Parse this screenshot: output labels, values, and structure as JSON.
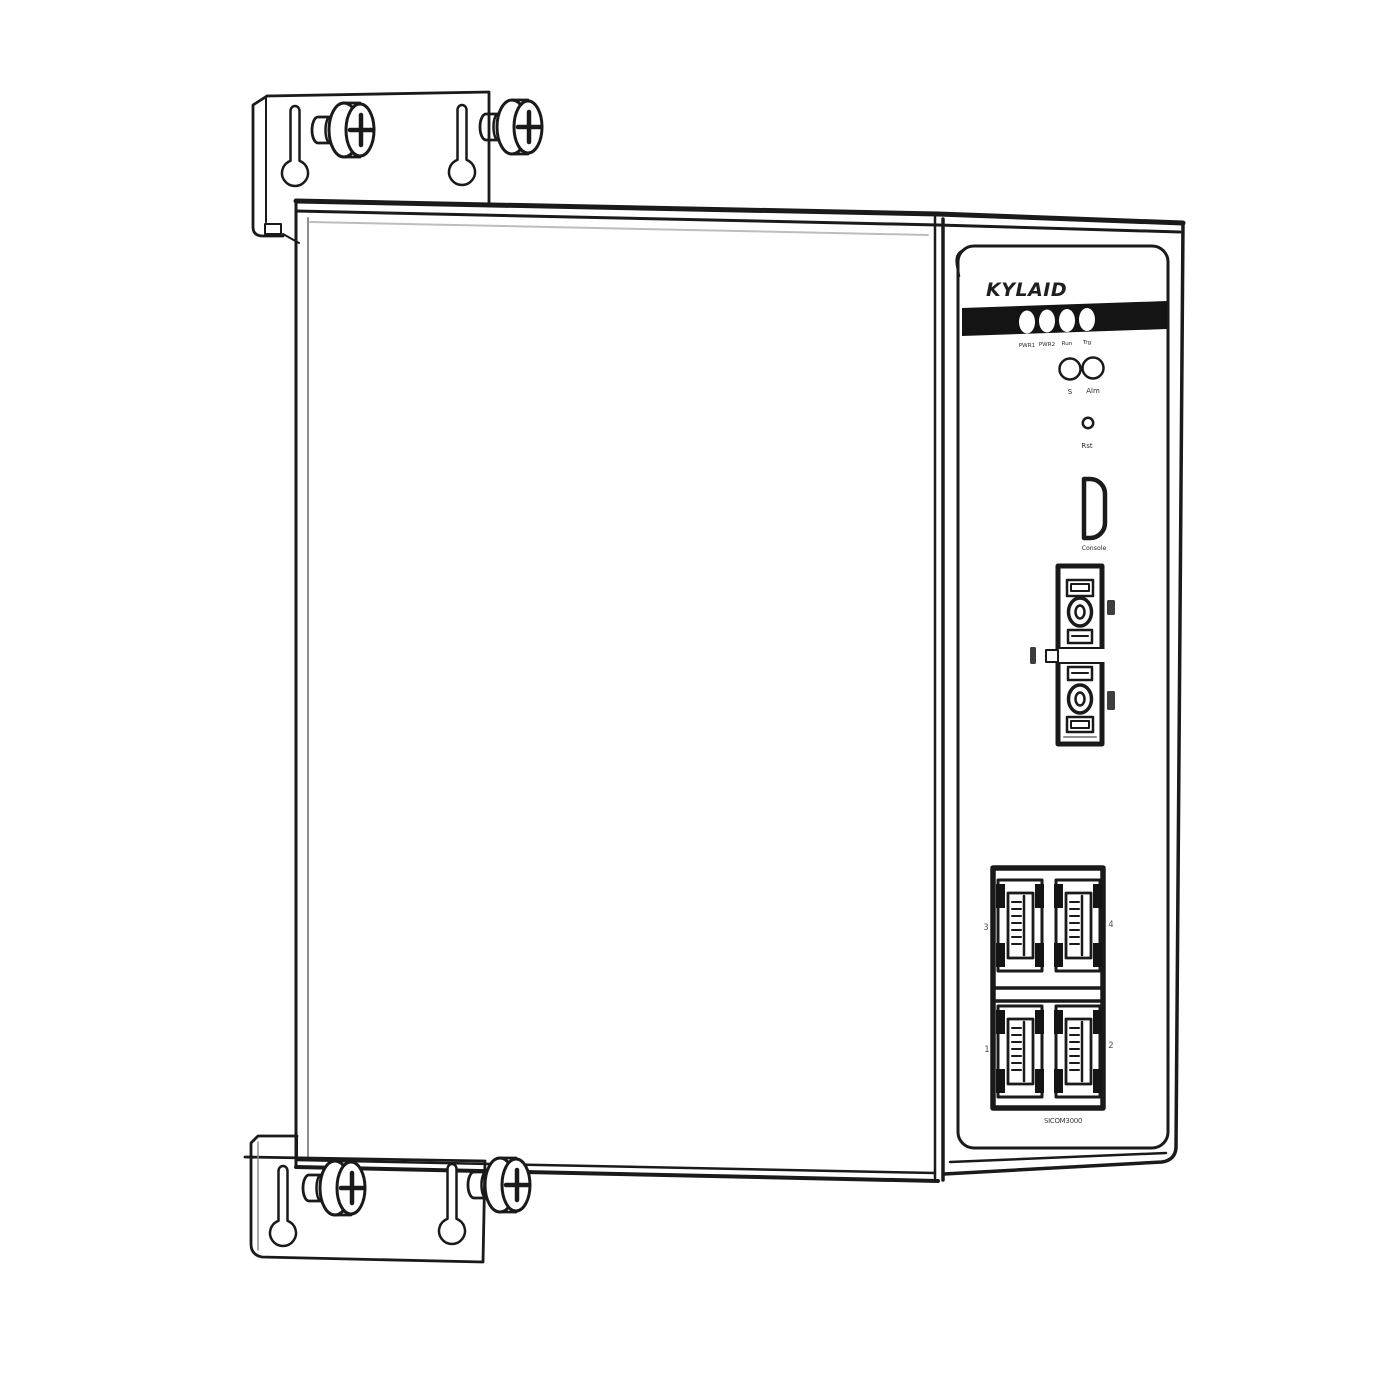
{
  "front_panel": {
    "brand_logo": "KYLAID",
    "led_labels": [
      "PWR1",
      "PWR2",
      "Run",
      "Trg"
    ],
    "status_labels": [
      "S",
      "Alm"
    ],
    "reset_label": "Rst",
    "console_label": "Console",
    "port_numbers": {
      "top_left": "3",
      "top_right": "4",
      "bottom_left": "1",
      "bottom_right": "2"
    },
    "model_label": "SICOM3000"
  },
  "colors": {
    "line": "#1a1a1a",
    "shade": "#8f8f8f",
    "led_band": "#0d0d0d",
    "led": "#ffffff",
    "background": "#ffffff"
  }
}
